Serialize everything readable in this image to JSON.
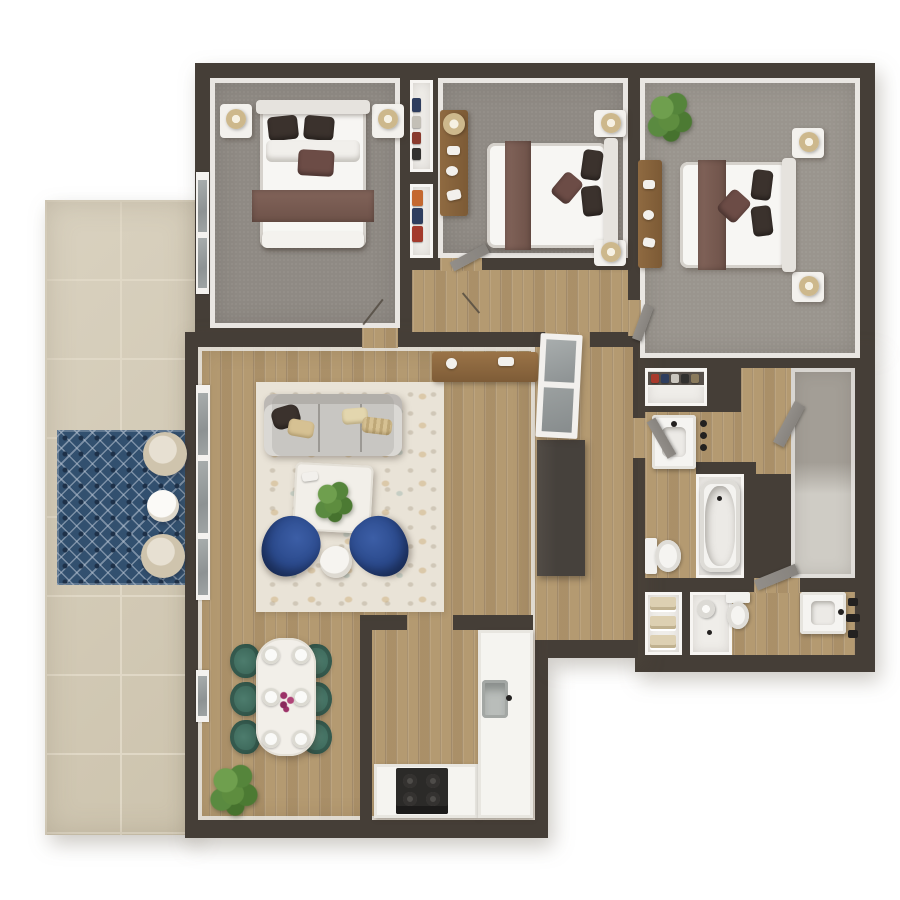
{
  "title": "3D apartment floor plan — top-down render",
  "colors": {
    "background": "#ffffff",
    "wall": "#453e37",
    "wall_face": "#e9e6e2",
    "carpet": "#8f8a84",
    "carpet_light": "#9a958e",
    "wood": "#b49a71",
    "patio_tile": "#d3cab5",
    "patio_grout": "#e0d8c6",
    "rug_navy": "#32506f",
    "rug_navy_dark": "#1d3048",
    "rug_cream": "#e9e3d7",
    "sofa_gray": "#c8c6c2",
    "chair_blue": "#2b4a8c",
    "chair_teal": "#3e6a5c",
    "pillow_dark": "#3b322d",
    "pillow_tan": "#d6c193",
    "accent_mauve": "#6c4c46",
    "runner_mauve": "#82645a",
    "bed_white": "#f7f6f3",
    "furn_wood": "#8f6a41",
    "cabinet_dark": "#46413c",
    "glass": "#989c9d",
    "appliance_black": "#2b2a28",
    "steel": "#b9bdba",
    "towel_beige": "#ddd0b2",
    "door_gray": "#87837e",
    "white_floor": "#efede9",
    "flower_magenta": "#9c3268",
    "plant_green": "#5e8d3f",
    "lamp_tan": "#cdb88c"
  },
  "floor_plan": {
    "type": "3d-top-down-apartment",
    "rooms": [
      {
        "name": "bedroom-1",
        "floor": "carpet",
        "furniture": [
          "queen-bed",
          "nightstand-left",
          "nightstand-right",
          "table-lamps",
          "window"
        ]
      },
      {
        "name": "closet-upper",
        "floor": "white",
        "furniture": [
          "shelved-folded-clothes"
        ]
      },
      {
        "name": "closet-lower",
        "floor": "white",
        "furniture": [
          "hanging-clothes"
        ]
      },
      {
        "name": "bedroom-2",
        "floor": "carpet",
        "furniture": [
          "queen-bed",
          "dresser-with-lamp",
          "nightstand-top",
          "nightstand-bottom"
        ]
      },
      {
        "name": "bedroom-3",
        "floor": "carpet",
        "furniture": [
          "queen-bed",
          "dresser",
          "nightstand-top",
          "nightstand-bottom",
          "potted-plant"
        ]
      },
      {
        "name": "hallway",
        "floor": "wood",
        "furniture": [
          "glass-door-ajar"
        ]
      },
      {
        "name": "living-room",
        "floor": "wood",
        "furniture": [
          "speckled-area-rug",
          "gray-sofa",
          "throw-pillows",
          "marble-coffee-table",
          "potted-plant",
          "blue-accent-chair-left",
          "blue-accent-chair-right",
          "round-side-table",
          "console-table",
          "dark-media-cabinet"
        ]
      },
      {
        "name": "dining-area",
        "floor": "wood",
        "furniture": [
          "white-dining-table",
          "six-teal-chairs",
          "six-place-settings",
          "flower-centerpiece",
          "floor-plant"
        ]
      },
      {
        "name": "kitchen",
        "floor": "wood",
        "furniture": [
          "u-shaped-counter",
          "black-range",
          "steel-sink"
        ]
      },
      {
        "name": "bathroom-1",
        "floor": "wood",
        "furniture": [
          "vanity-sink",
          "wall-hooks",
          "toilet",
          "bathtub"
        ]
      },
      {
        "name": "walk-in-closet",
        "floor": "carpet",
        "furniture": [
          "door-ajar"
        ]
      },
      {
        "name": "bathroom-2",
        "floor": "wood",
        "furniture": [
          "linen-shelves-towels",
          "walk-in-shower",
          "toilet",
          "vanity-sink",
          "black-wall-fixtures",
          "door-ajar"
        ]
      },
      {
        "name": "patio",
        "floor": "stone-tile",
        "furniture": [
          "navy-diamond-rug",
          "round-lounge-chair",
          "round-outdoor-table",
          "round-lounge-chair"
        ]
      }
    ]
  }
}
